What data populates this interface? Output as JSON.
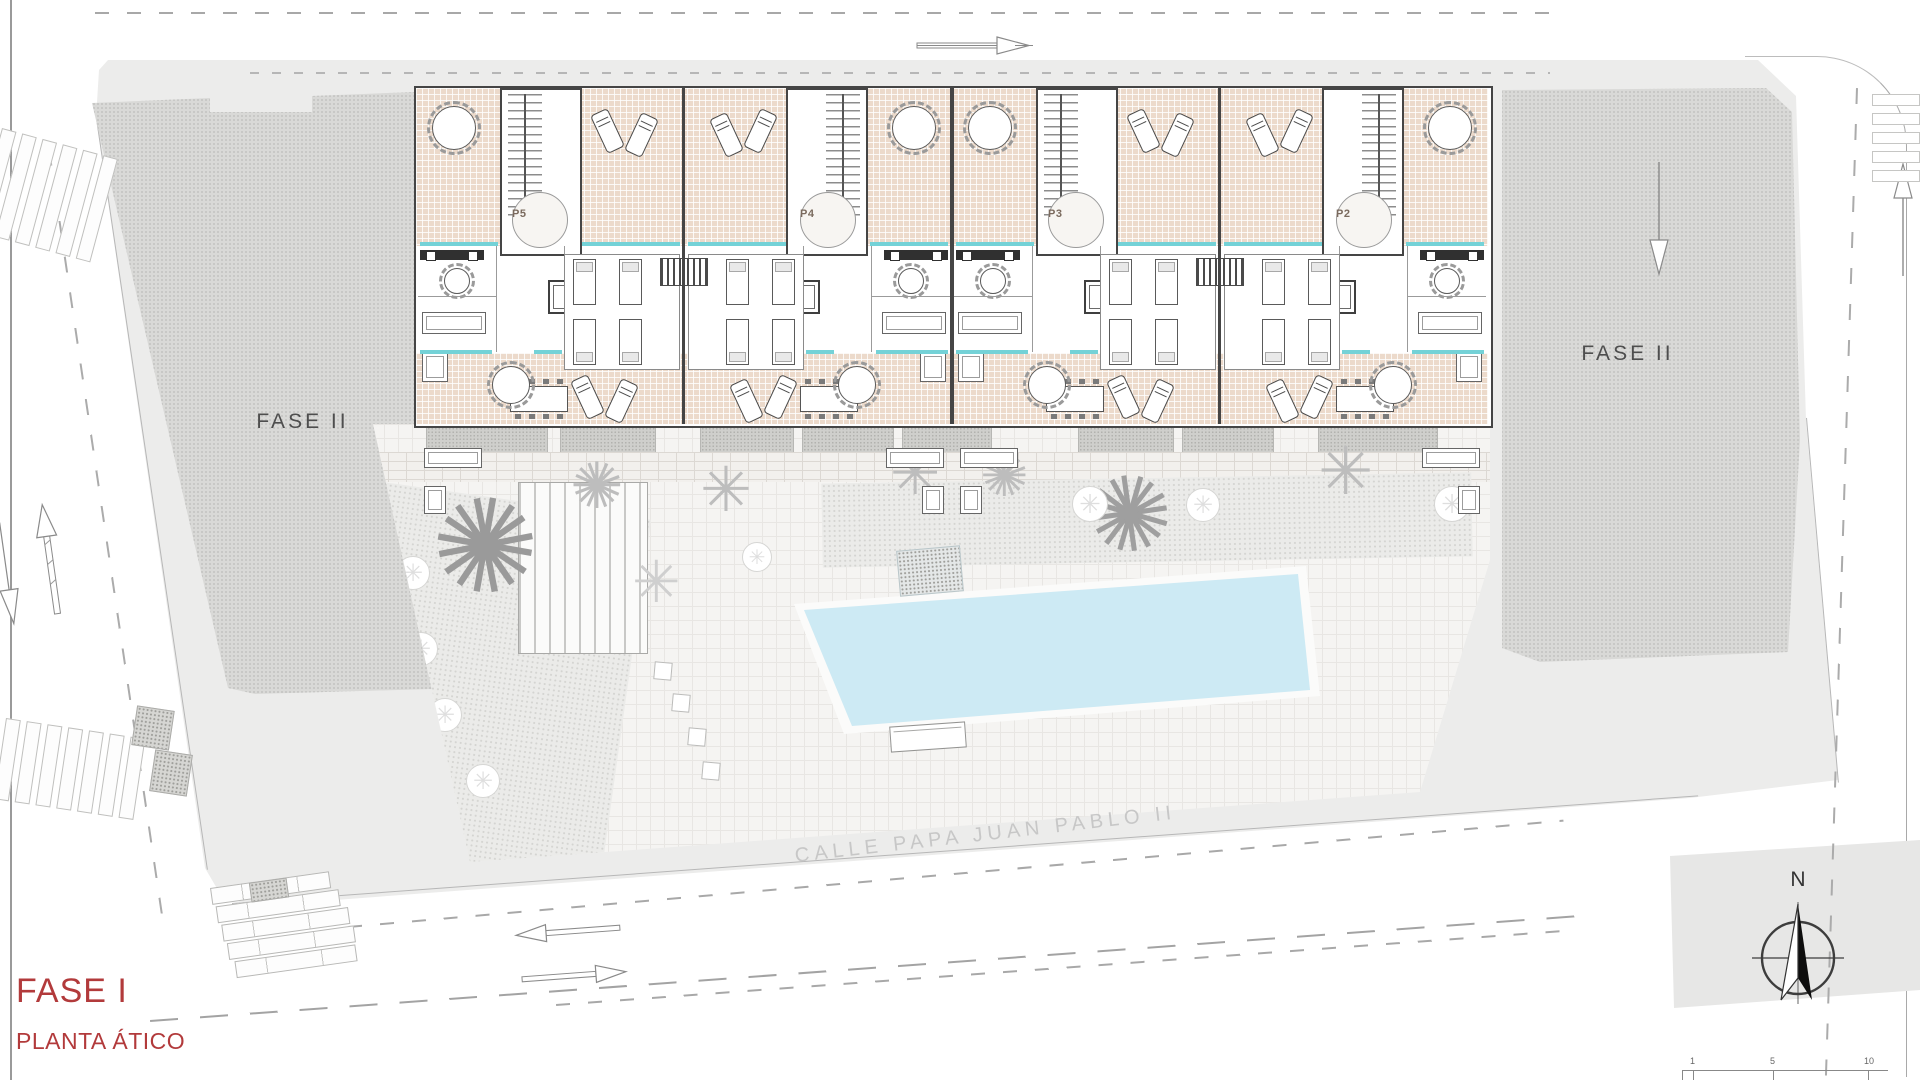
{
  "drawing": {
    "phase_title": "FASE I",
    "floor_title": "PLANTA ÁTICO",
    "street_name": "CALLE PAPA JUAN PABLO II",
    "phase2_left_label": "FASE II",
    "phase2_right_label": "FASE II",
    "north_label": "N",
    "units": [
      {
        "id": "P5"
      },
      {
        "id": "P4"
      },
      {
        "id": "P3"
      },
      {
        "id": "P2"
      }
    ],
    "scale_ticks": [
      "1",
      "5",
      "10"
    ],
    "colors": {
      "title_red": "#b23a3b",
      "terrace_pink": "#ecdacb",
      "pool_blue": "#cdeaf4",
      "window_teal": "#74d2d7",
      "phase2_gray": "#d9d9d7",
      "wall_dark": "#454545"
    }
  }
}
